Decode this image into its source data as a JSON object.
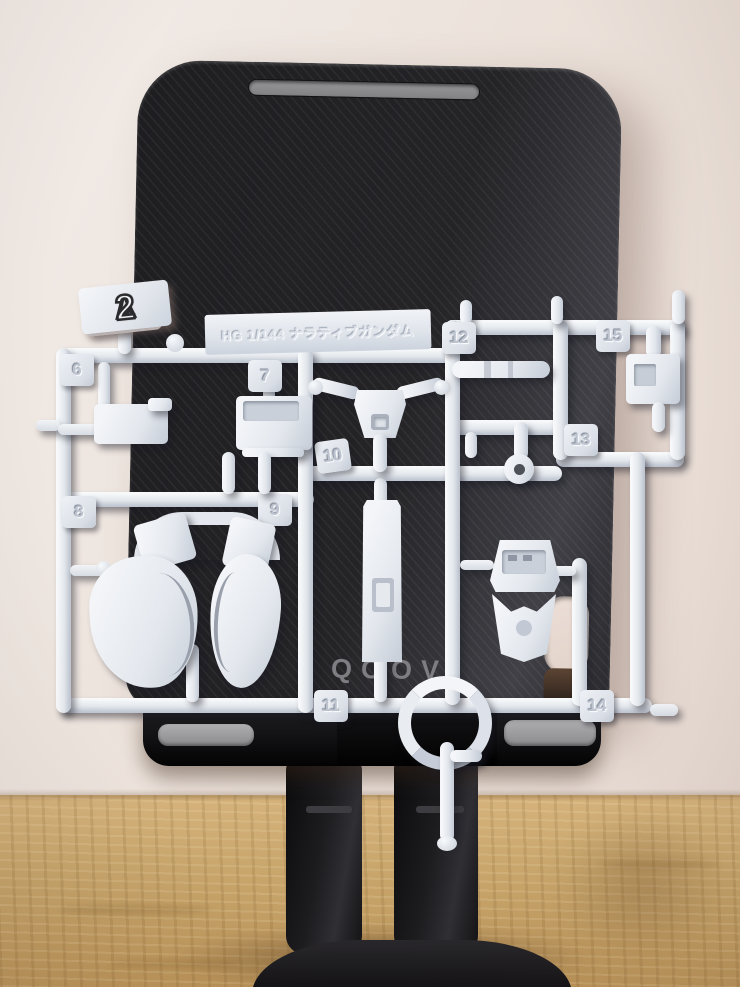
{
  "runner": {
    "code": {
      "letter": "A",
      "separator": "-",
      "number": "2"
    },
    "name_plate": "HG 1/144 ナラティブガンダム",
    "part_numbers": [
      "6",
      "7",
      "8",
      "9",
      "10",
      "11",
      "12",
      "13",
      "14",
      "15"
    ],
    "plastic_color": "#e8ebf0"
  },
  "stand": {
    "brand": "QOOVI",
    "body_color": "#1f1f22",
    "slot_color": "#8f8f92",
    "pad_color": "#9c9c9e"
  },
  "scene": {
    "wall_color": "#ece2db",
    "desk_color": "#c9a76d",
    "brand_text_color": "#7e7e82"
  }
}
